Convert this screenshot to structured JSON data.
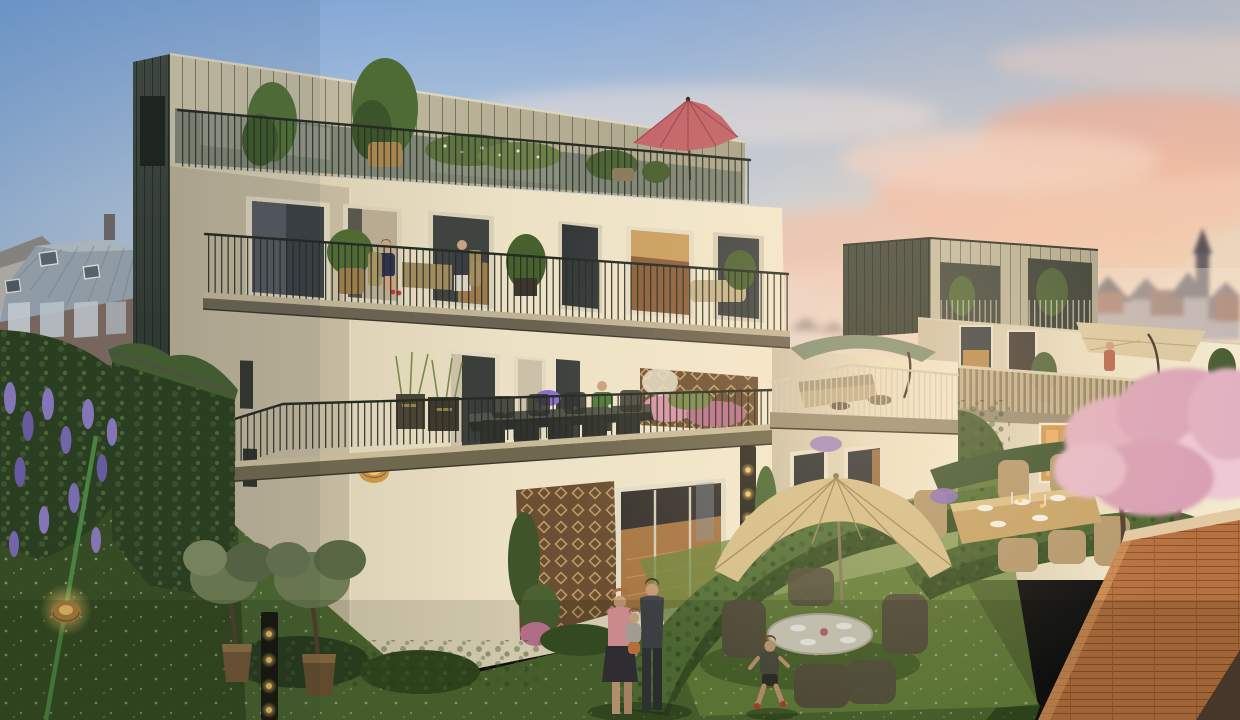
{
  "scene": {
    "type": "architectural-rendering",
    "time_of_day": "sunset golden hour",
    "description": "Photorealistic real-estate rendering of a terraced cream stucco apartment residence at dusk, with zinc-clad penthouse volumes, planted balconies, roof terraces with parasols, and private rear gardens with hedges, lawns and residents.",
    "background": {
      "left": "old town houses with gray standing-seam metal roofs, skylights and brick facades behind shrubs",
      "right": "hazy distant city rooftops with slate gables, brick houses and a church spire",
      "sky": "blue sky fading to warm pink sunset clouds on the right"
    },
    "main_building": {
      "floors": 4,
      "facade": "cream stucco",
      "penthouse_cladding": "champagne metal panels with dark zinc side fin",
      "railings": "thin dark steel rod balustrades",
      "roof_terrace": {
        "umbrella_color_name": "dusty rose",
        "plants": [
          "potted shrub in basket",
          "white flowering planters",
          "round clipped bush"
        ]
      },
      "third_floor_balcony": {
        "people": 2,
        "furniture": [
          "wicker chairs",
          "small table"
        ],
        "plants": [
          "potted shrubs"
        ]
      },
      "second_floor_terrace": {
        "furniture": [
          "long black dining table",
          "dining chairs",
          "lounge sofa",
          "side tables"
        ],
        "features": [
          "wood trellis with pink flowers",
          "ornamental grass planters",
          "rattan floor lantern",
          "sage cantilever umbrella"
        ],
        "people": 1
      },
      "ground_floor": {
        "features": [
          "sliding glass doors with warm wood interior",
          "climbing-plant trellis",
          "black multi-bulb floor lamps"
        ]
      }
    },
    "second_building": {
      "penthouse_cladding": "dark zinc and champagne panels with recessed planted loggias",
      "terrace": {
        "railing": "wood slat balustrade",
        "umbrella_color_name": "beige cantilever",
        "people": 1
      },
      "windows": "warm lit interiors at dusk"
    },
    "garden": {
      "lawns": "green lawns dotted with white daisies",
      "hedges": "rounded boxwood hedge bands dividing private gardens",
      "trees": [
        "olive trees in bronze pots",
        "pink blossom tree",
        "dark conifers",
        "slim cypress"
      ],
      "climbers": [
        "purple wisteria over garden wall",
        "green living wall"
      ],
      "furniture": [
        "large beige garden umbrella",
        "round glass table with plates",
        "dark wicker armchairs",
        "wooden dining table set with white plates and candles",
        "tan wicker chairs"
      ],
      "lighting": [
        "glowing rattan ground lanterns",
        "black frame floor lamps with warm bulbs"
      ],
      "fence": "thin green wire fence post"
    },
    "people": [
      "woman seated on third-floor balcony with red shoes",
      "man seated on third-floor balcony",
      "resident in green hoodie at second-floor terrace table",
      "resident on neighboring building terrace",
      "woman in pink top holding toddler",
      "man standing beside family",
      "boy running on lawn with red shoes"
    ],
    "foreground": {
      "wall": "orange brick garden wall with pale concrete coping, bottom right corner"
    }
  },
  "palette": {
    "sky_top": "#86a9d6",
    "sky_mid": "#c9d4de",
    "sky_warm": "#efdfd4",
    "sky_horizon": "#f4e4d2",
    "cloud_pink": "#eec0ae",
    "cloud_salmon": "#e8ae9b",
    "skyline": "#5a545c",
    "skyline_brick": "#8a5a4a",
    "old_roof": "#9aa6ae",
    "old_brick": "#7e6c60",
    "zinc_dark": "#424a40",
    "zinc_panel": "#c6bfa5",
    "penthouse_panel": "#c7c0a6",
    "facade_cream": "#ece1c4",
    "facade_shadow": "#cdc3a8",
    "facade_sunlit": "#f4ead0",
    "railing_dark": "#262b24",
    "railing_light": "#d6cdb6",
    "window_dark": "#3c4144",
    "window_warm": "#cf9a55",
    "interior_wood": "#a87845",
    "umbrella_red": "#c4666a",
    "umbrella_sage": "#7e8f74",
    "umbrella_beige": "#d6c08c",
    "umbrella_terrace": "#dcc9a2",
    "grass": "#4d6830",
    "grass_dark": "#35481f",
    "grass_sunlit": "#6f8a40",
    "hedge": "#3a5226",
    "foliage_dark": "#2c4020",
    "olive": "#6f7d52",
    "wisteria": "#8d7cc0",
    "blossom_pink": "#e2b1c1",
    "brick_wall": "#b5713f",
    "brick_mortar": "#8e4f2c",
    "wood_table": "#c7a468",
    "rattan": "#b59a6f",
    "lantern_glow": "#f7c96a",
    "trellis_wood": "#6b4f33"
  }
}
